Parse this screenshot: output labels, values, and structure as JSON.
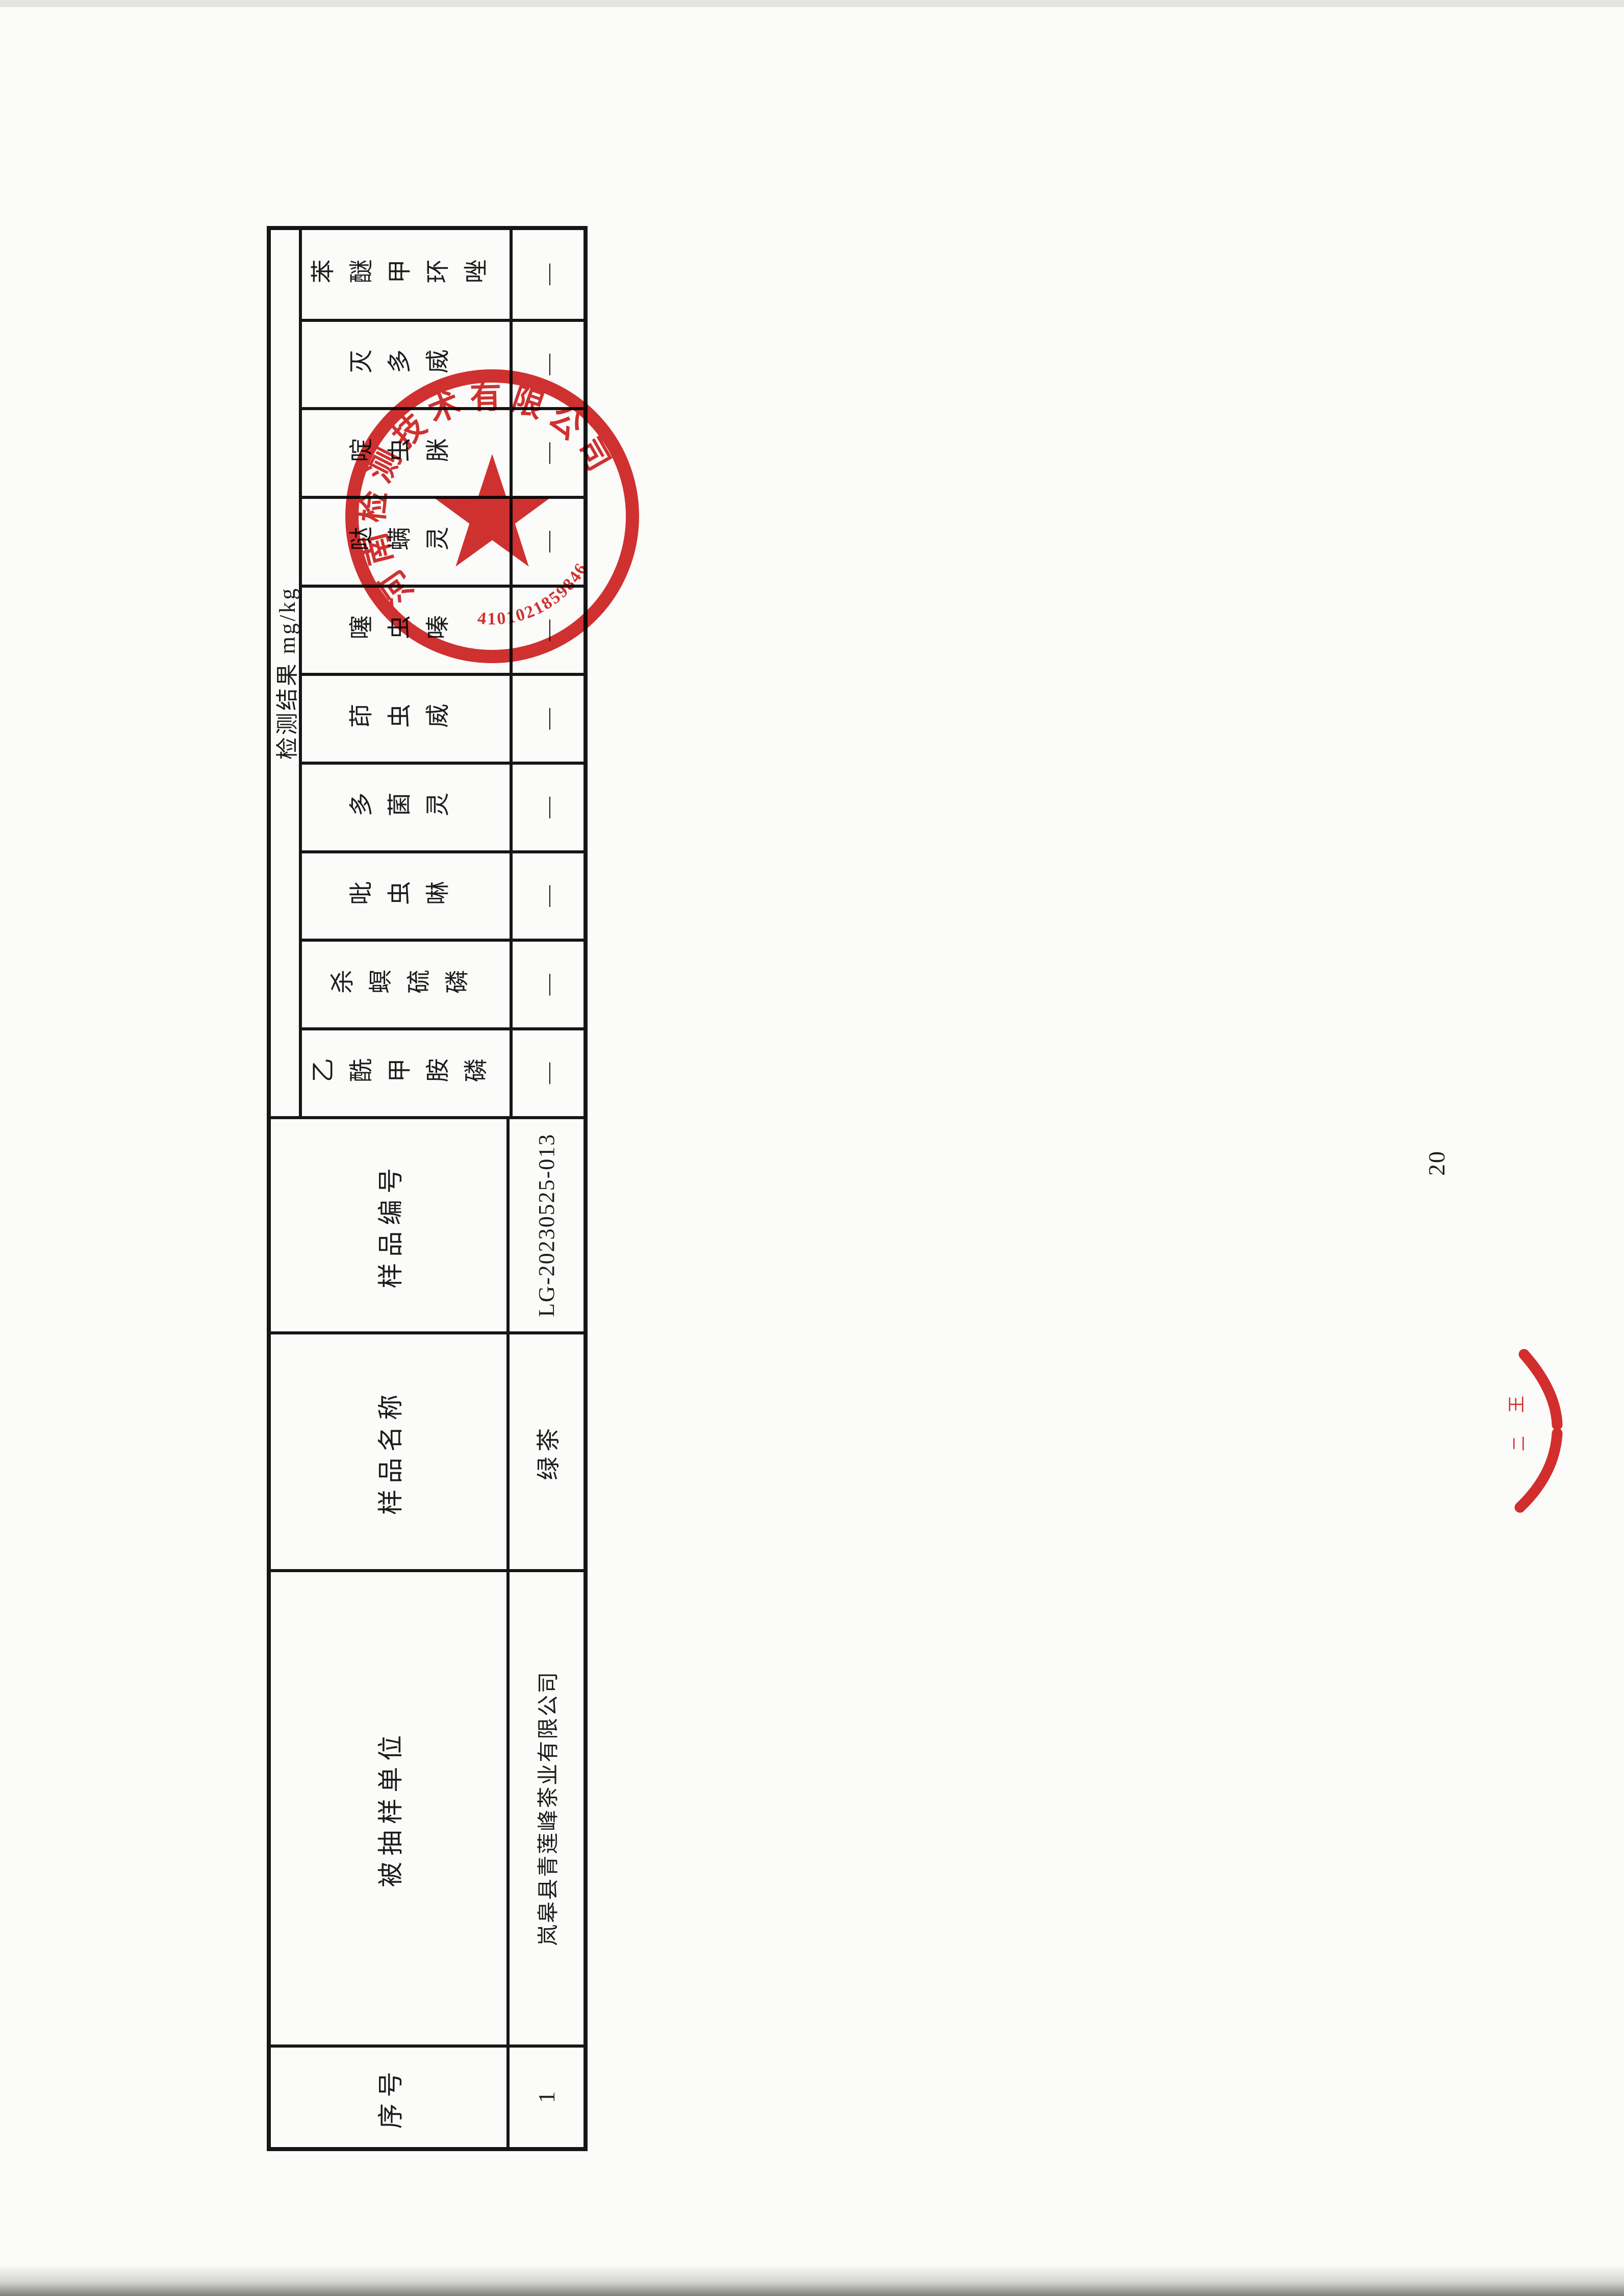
{
  "page": {
    "number": "20"
  },
  "table": {
    "info_columns": [
      {
        "label": "序号",
        "value": "1"
      },
      {
        "label": "被抽样单位",
        "value": "岚皋县青莲峰茶业有限公司"
      },
      {
        "label": "样品名称",
        "value": "绿茶"
      },
      {
        "label": "样品编号",
        "value": "LG-20230525-013"
      }
    ],
    "results_group": {
      "label": "检测结果 mg/kg",
      "pesticides": [
        {
          "name": "乙酰甲胺磷",
          "value": "—"
        },
        {
          "name": "杀螟硫磷",
          "value": "—"
        },
        {
          "name": "吡虫啉",
          "value": "—"
        },
        {
          "name": "多菌灵",
          "value": "—"
        },
        {
          "name": "茚虫威",
          "value": "—"
        },
        {
          "name": "噻虫嗪",
          "value": "—"
        },
        {
          "name": "哒螨灵",
          "value": "—"
        },
        {
          "name": "啶虫脒",
          "value": "—"
        },
        {
          "name": "灭多威",
          "value": "—"
        },
        {
          "name": "苯醚甲环唑",
          "value": "—"
        }
      ]
    }
  },
  "seal": {
    "arc_text": "河南检测技术有限公司",
    "serial_number": "4101021859846",
    "color": "#cf1f1f"
  },
  "partial_seal": {
    "fragments": [
      "王",
      "二"
    ]
  }
}
